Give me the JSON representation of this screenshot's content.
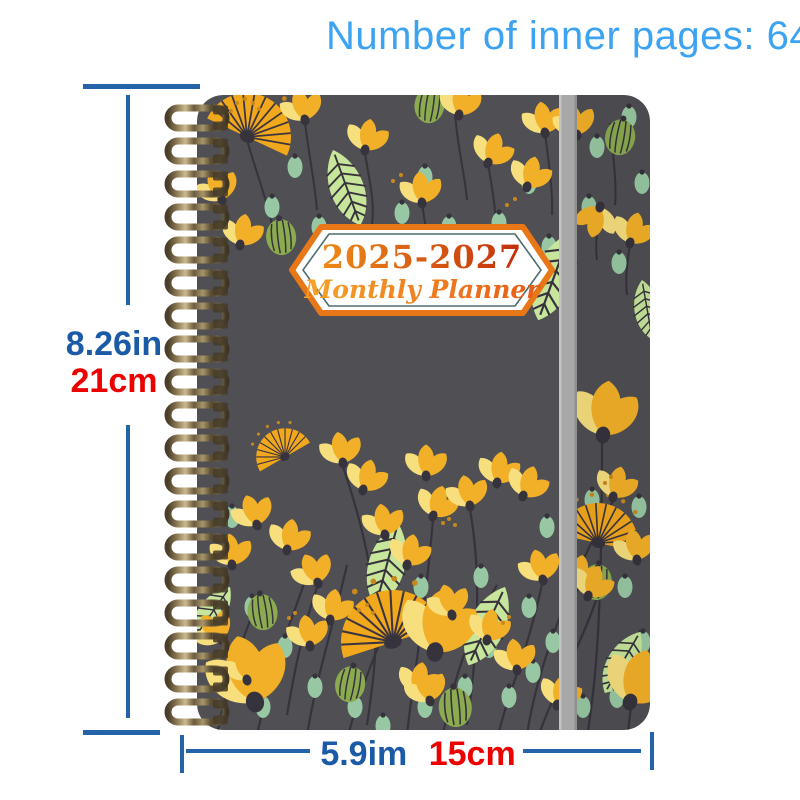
{
  "title": {
    "text": "Number of inner pages: 64",
    "color": "#3BA3F2"
  },
  "dimensions": {
    "height": {
      "inches": "8.26in",
      "cm": "21cm"
    },
    "width": {
      "inches": "5.9im",
      "cm": "15cm"
    },
    "inch_label_color": "#1B5AA7",
    "cm_label_color": "#EC0000",
    "line_color": "#2563A8"
  },
  "planner": {
    "badge": {
      "line1": "2025-2027",
      "line2": "Monthly Planner",
      "border_color": "#E87817",
      "inner_line_color": "#4F6E6E",
      "fill": "#FFFFFF"
    },
    "palette": {
      "cover": "#4F4F54",
      "elastic_band": "#A8A8A8",
      "coil_bronze": "#8B7B55",
      "flower_gold": "#F2B028",
      "flower_light_yellow": "#F7DF7E",
      "fan_orange": "#F2A81C",
      "leaf_green": "#C7E59B",
      "seed_mint": "#98C8A3",
      "pod_olive": "#8CAB50",
      "stem_dark": "#37333D"
    }
  }
}
